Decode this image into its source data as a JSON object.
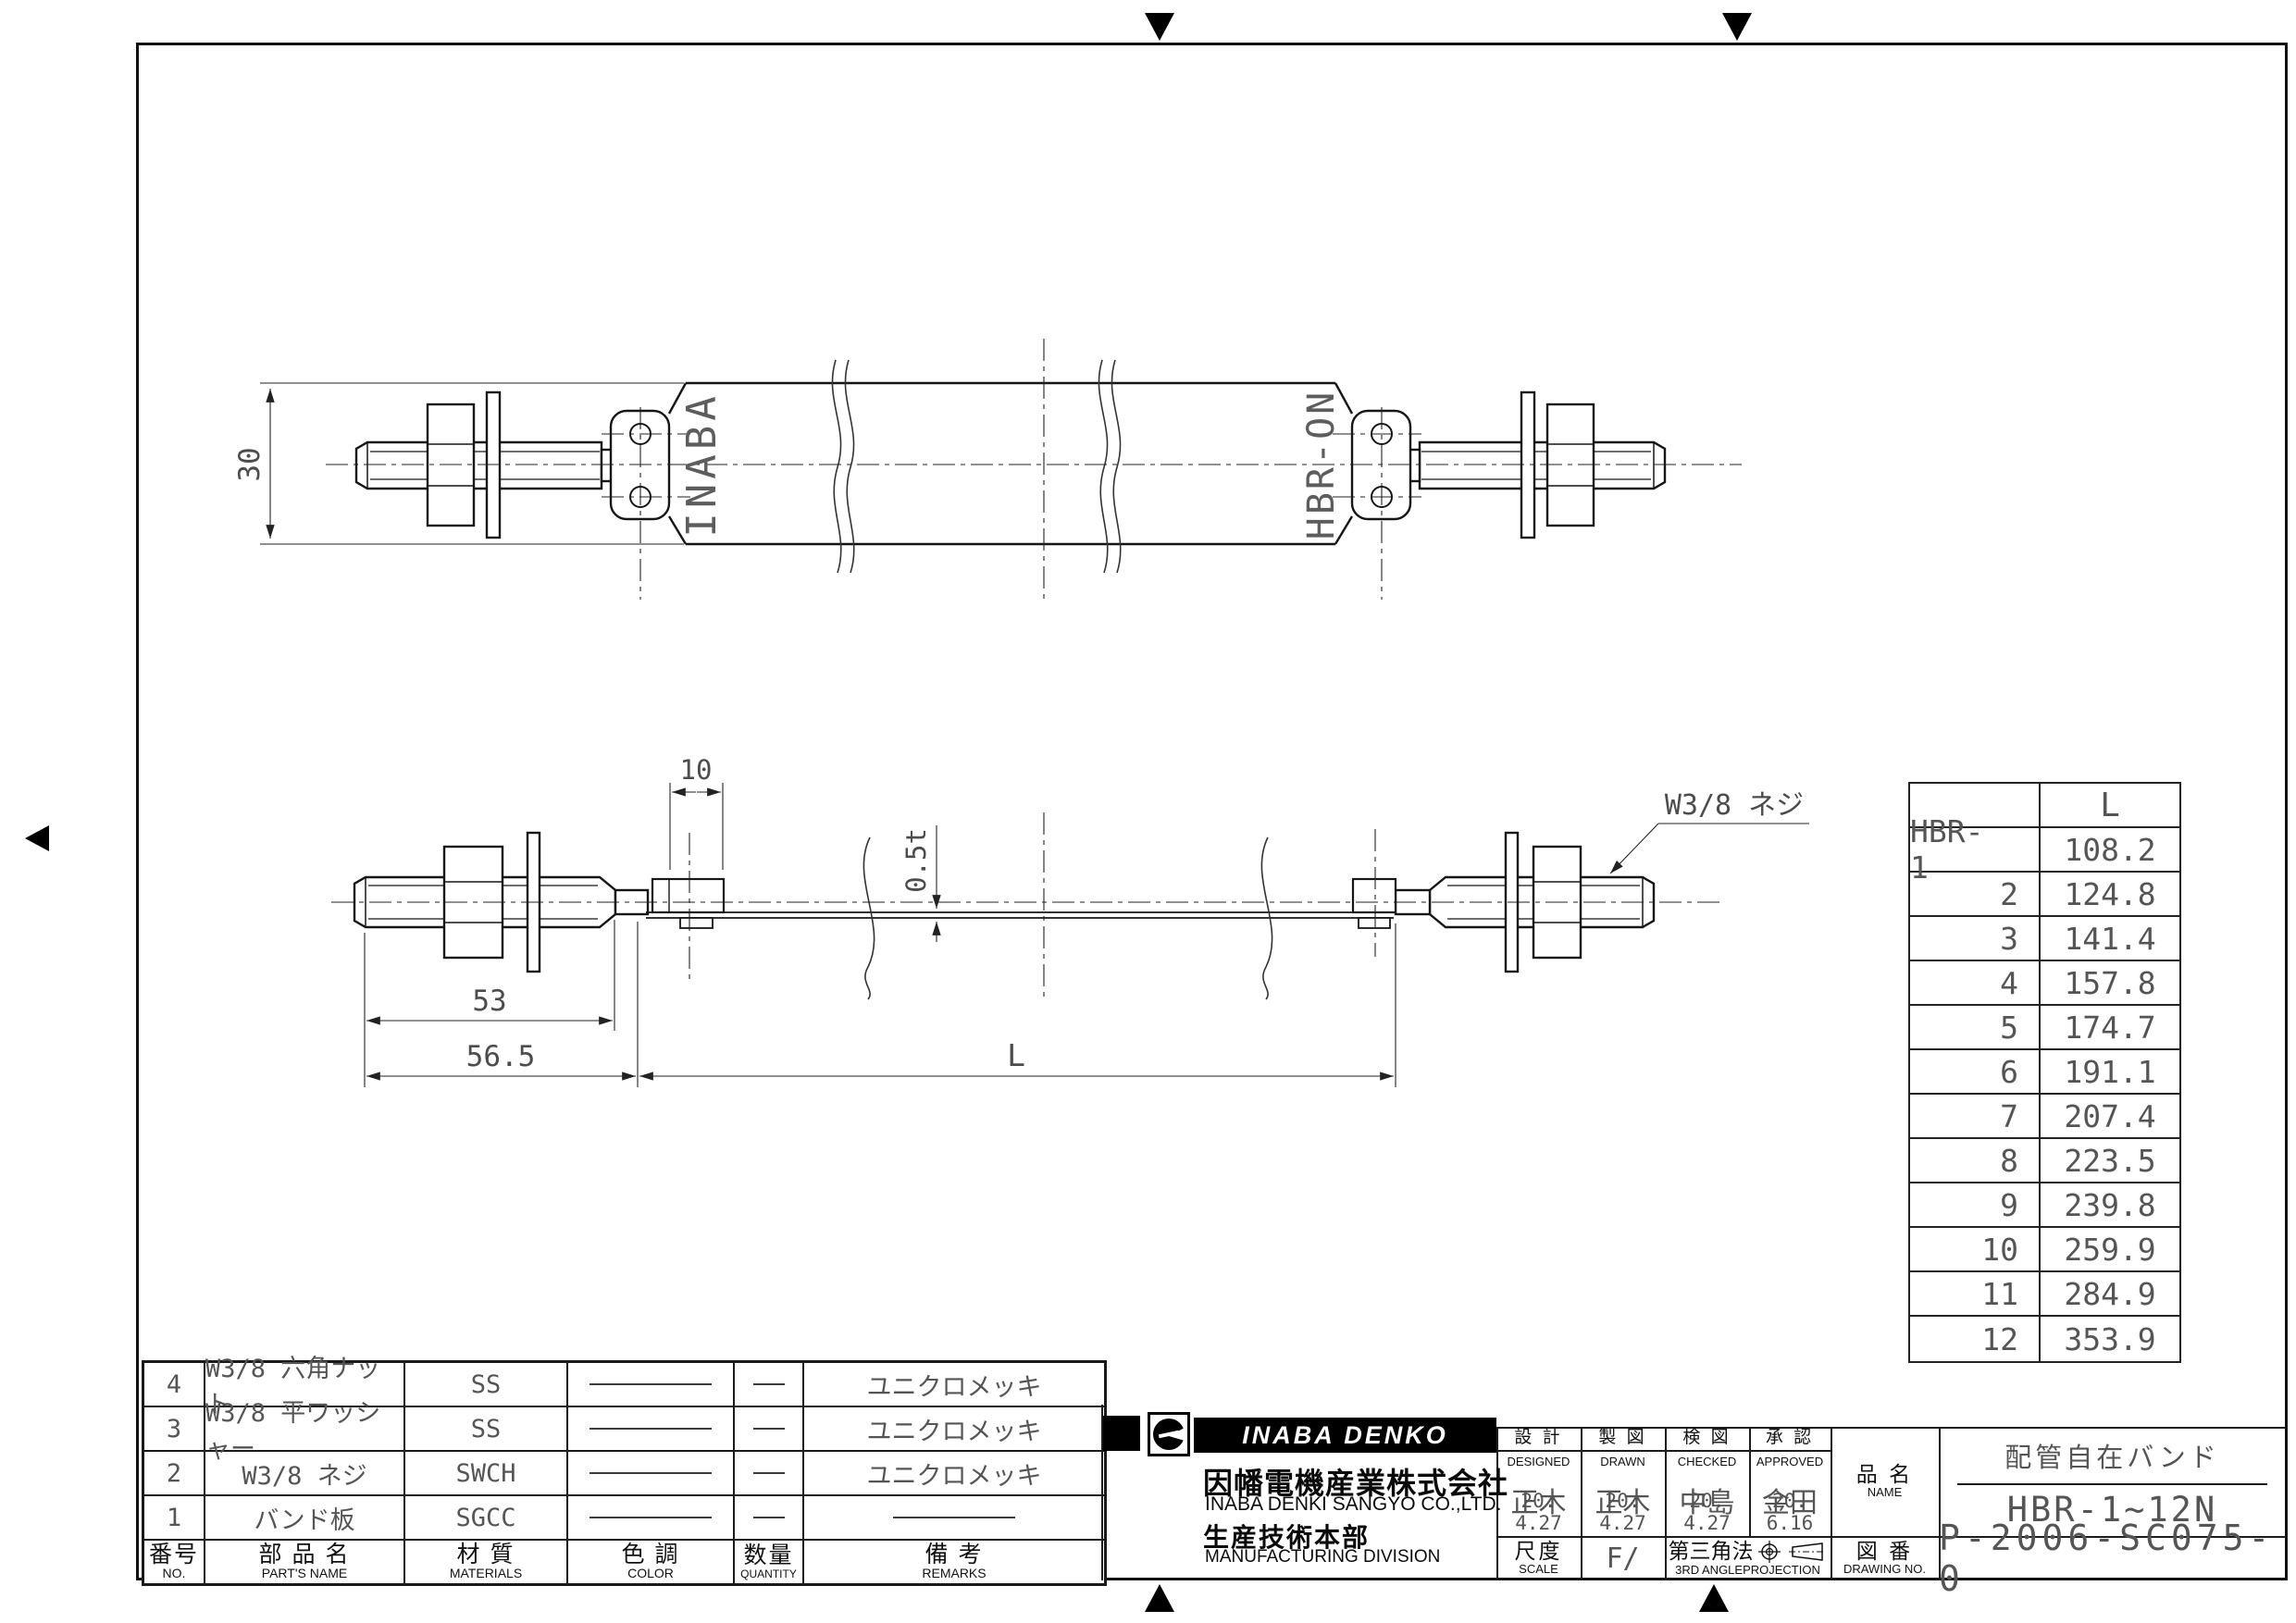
{
  "drawing": {
    "top_view": {
      "dim_width": "30",
      "stamp_left": "INABA",
      "stamp_right": "HBR-ON"
    },
    "bottom_view": {
      "dim_tab_width": "10",
      "dim_thickness": "0.5t",
      "dim_thread_len": "53",
      "dim_end_len": "56.5",
      "dim_band_len": "L",
      "thread_label": "W3/8 ネジ"
    }
  },
  "size_table": {
    "length_header": "L",
    "rows": [
      {
        "model": "HBR- 1",
        "length": "108.2"
      },
      {
        "model": "2",
        "length": "124.8"
      },
      {
        "model": "3",
        "length": "141.4"
      },
      {
        "model": "4",
        "length": "157.8"
      },
      {
        "model": "5",
        "length": "174.7"
      },
      {
        "model": "6",
        "length": "191.1"
      },
      {
        "model": "7",
        "length": "207.4"
      },
      {
        "model": "8",
        "length": "223.5"
      },
      {
        "model": "9",
        "length": "239.8"
      },
      {
        "model": "10",
        "length": "259.9"
      },
      {
        "model": "11",
        "length": "284.9"
      },
      {
        "model": "12",
        "length": "353.9"
      }
    ]
  },
  "parts_list": {
    "headers": {
      "no_jp": "番号",
      "no_en": "NO.",
      "name_jp": "部 品 名",
      "name_en": "PART'S NAME",
      "material_jp": "材 質",
      "material_en": "MATERIALS",
      "color_jp": "色 調",
      "color_en": "COLOR",
      "qty_jp": "数量",
      "qty_en": "QUANTITY",
      "remarks_jp": "備  考",
      "remarks_en": "REMARKS"
    },
    "rows": [
      {
        "no": "4",
        "name": "W3/8 六角ナット",
        "material": "SS",
        "remarks": "ユニクロメッキ"
      },
      {
        "no": "3",
        "name": "W3/8 平ワッシャー",
        "material": "SS",
        "remarks": "ユニクロメッキ"
      },
      {
        "no": "2",
        "name": "W3/8 ネジ",
        "material": "SWCH",
        "remarks": "ユニクロメッキ"
      },
      {
        "no": "1",
        "name": "バンド板",
        "material": "SGCC",
        "remarks": ""
      }
    ]
  },
  "title_block": {
    "brand": "INABA DENKO",
    "company_jp": "因幡電機産業株式会社",
    "company_en": "INABA DENKI SANGYO CO.,LTD.",
    "division_jp": "生産技術本部",
    "division_en": "MANUFACTURING DIVISION",
    "sig_columns": [
      {
        "label_jp": "設 計",
        "label_en": "DESIGNED",
        "name": "正木",
        "date": "20. 4.27"
      },
      {
        "label_jp": "製 図",
        "label_en": "DRAWN",
        "name": "正木",
        "date": "20. 4.27"
      },
      {
        "label_jp": "検 図",
        "label_en": "CHECKED",
        "name": "中島",
        "date": "20. 4.27"
      },
      {
        "label_jp": "承 認",
        "label_en": "APPROVED",
        "name": "金田",
        "date": "20. 6.16"
      }
    ],
    "scale_jp": "尺度",
    "scale_en": "SCALE",
    "scale_value": "F/",
    "projection_jp": "第三角法",
    "projection_en": "3RD ANGLEPROJECTION",
    "name_jp": "品 名",
    "name_en": "NAME",
    "product_name": "配管自在バンド",
    "product_model": "HBR-1~12N",
    "dwg_jp": "図 番",
    "dwg_en": "DRAWING NO.",
    "drawing_no": "P-2006-SC075-0"
  }
}
